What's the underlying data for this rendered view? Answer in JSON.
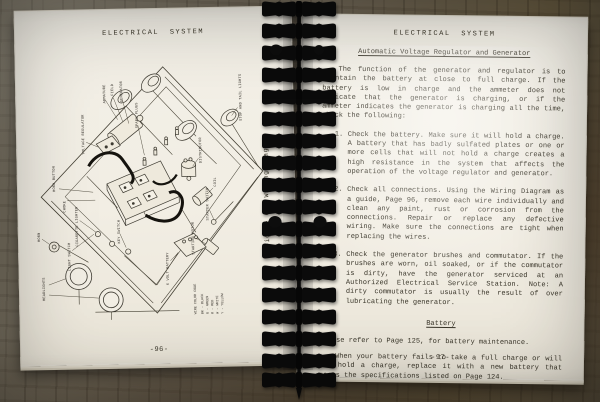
{
  "left_page": {
    "header": "ELECTRICAL SYSTEM",
    "figure_caption": "Figure 64.  Wiring Diagram",
    "page_number": "-96-",
    "diagram": {
      "labels": {
        "voltage_regulator": "VOLTAGE REGULATOR",
        "armature": "ARMATURE",
        "field": "FIELD",
        "generator": "GENERATOR",
        "spark_plugs": "SPARK PLUGS",
        "distributor": "DISTRIBUTOR",
        "coil": "COIL",
        "stop_tail_lights": "STOP AND TAIL LIGHTS",
        "horn_button": "HORN BUTTON",
        "choke": "CHOKE",
        "cigarette_lighter": "CIGARETTE LIGHTER",
        "key_switch": "KEY SWITCH",
        "light_switch": "LIGHT SWITCH",
        "starter_switch": "STARTER SWITCH",
        "starting_motor": "STARTING MOTOR",
        "horn": "HORN",
        "headlights": "HEADLIGHTS",
        "battery": "6 VOLT BATTERY",
        "wire_code_title": "WIRE COLOR CODE",
        "wire_code_1": "BK - BLACK",
        "wire_code_2": "G - GREEN",
        "wire_code_3": "R - RED",
        "wire_code_4": "W - WHITE",
        "wire_code_5": "Y - YELLOW"
      }
    }
  },
  "right_page": {
    "header": "ELECTRICAL SYSTEM",
    "section_title": "Automatic Voltage Regulator and Generator",
    "intro": "The function of the generator and regulator is to maintain the battery at close to full charge.  If the battery is low in charge and the ammeter does not indicate that the generator is charging, or if the ammeter indicates the generator is charging all the time, check the following:",
    "items": [
      {
        "num": "1.",
        "text": "Check the battery.  Make sure it will hold a charge. A battery that has badly sulfated plates or one or more cells that will not hold a charge creates a high resistance in the system that affects the operation of the voltage regulator and generator."
      },
      {
        "num": "2.",
        "text": "Check all connections.  Using the Wiring Diagram as a guide, Page 96, remove each wire individually and clean any paint, rust or corrosion from the connections.  Repair or replace any defective wiring.  Make sure the connections are tight when replacing the wires."
      },
      {
        "num": "3.",
        "text": "Check the generator brushes and commutator.  If the brushes are worn, oil soaked, or if the commutator is dirty, have the generator serviced at an Authorized Electrical Service Station.  Note:  A dirty commutator is usually the result of over lubricating the generator."
      }
    ],
    "battery_title": "Battery",
    "battery_p1": "Please refer to Page 125, for battery maintenance.",
    "battery_p2": "When your battery fails to take a full charge or will not hold a charge, replace it with a new battery that meets the specifications listed on Page 124.",
    "page_number": "-97-"
  }
}
